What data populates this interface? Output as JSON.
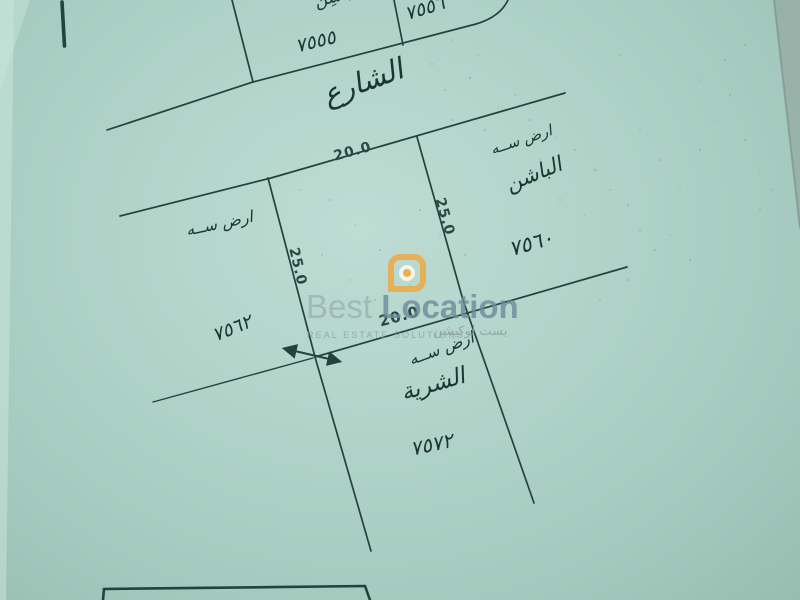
{
  "plan": {
    "street_label": "الشارع",
    "parcels": {
      "top_block_name": "الباشِن",
      "top_left_number": "٧٥٥٥",
      "top_right_number": "٧٥٥٦",
      "east_note": "ارض ســه",
      "east_name": "الباشن",
      "east_number": "٧٥٦٠",
      "west_note": "ارض ســه",
      "west_number": "٧٥٦٢",
      "south_note": "ارض ســه",
      "south_name": "الشرية",
      "south_number": "٧٥٧٢"
    },
    "dimensions": {
      "top": "20.0",
      "bottom": "20.0",
      "left": "25.0",
      "right": "25.0"
    }
  },
  "watermark": {
    "brand_first": "Best",
    "brand_second": "Location",
    "tagline": "REAL ESTATE SOLUTIONS",
    "arabic_name": "بست لوكيشن",
    "accent_color": "#f1a53c"
  },
  "colors": {
    "paper": "#aed2c7",
    "ink": "#24423c"
  }
}
